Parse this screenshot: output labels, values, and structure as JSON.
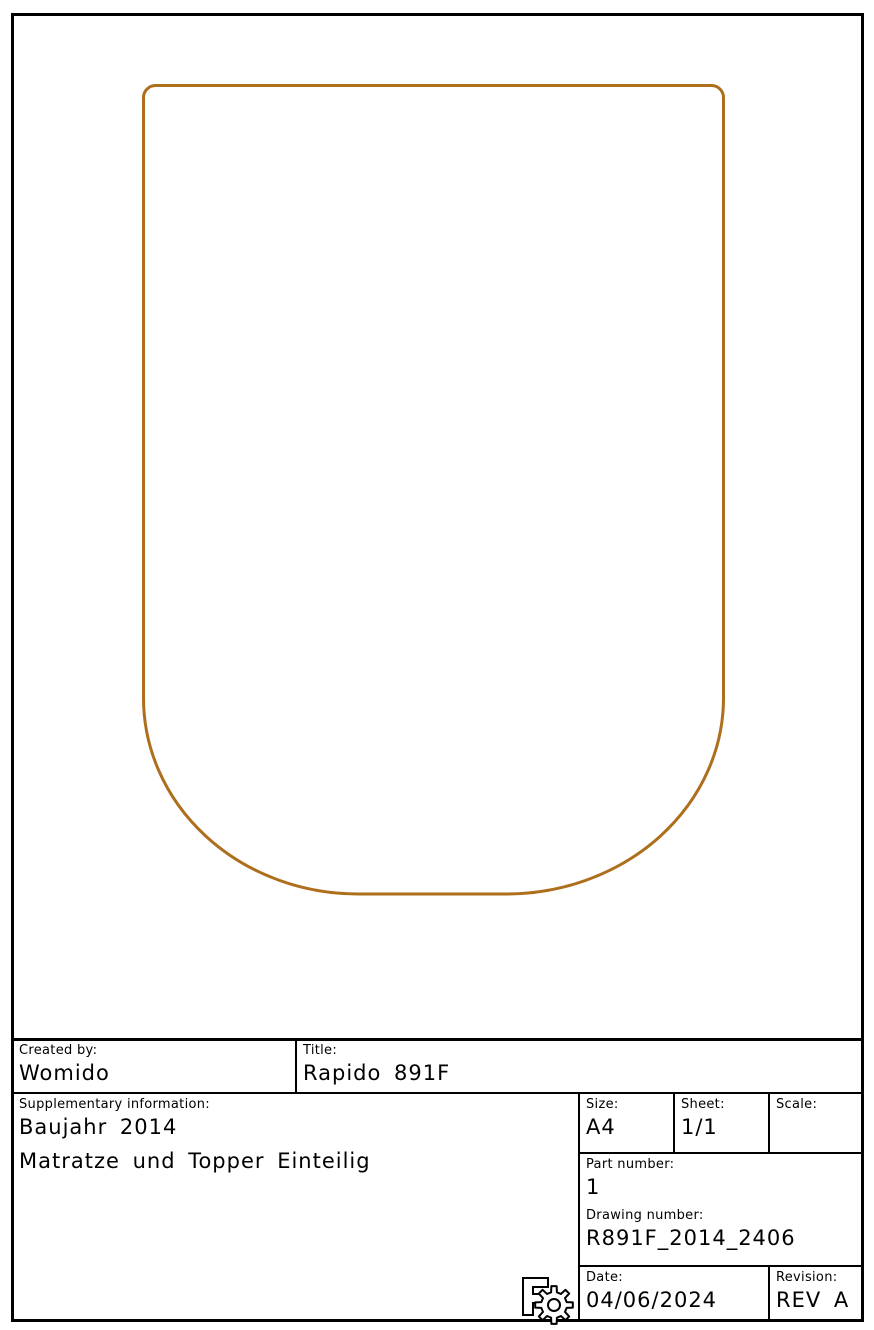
{
  "page": {
    "background": "#ffffff",
    "frame_color": "#000000"
  },
  "drawing": {
    "name": "mattress-outline",
    "outline_color": "#AE6F1D"
  },
  "title_block": {
    "created_by_label": "Created by:",
    "created_by_value": "Womido",
    "title_label": "Title:",
    "title_value": "Rapido 891F",
    "supplementary_label": "Supplementary information:",
    "supplementary_line1": "Baujahr 2014",
    "supplementary_line2": "Matratze und Topper Einteilig",
    "size_label": "Size:",
    "size_value": "A4",
    "sheet_label": "Sheet:",
    "sheet_value": "1/1",
    "scale_label": "Scale:",
    "scale_value": "",
    "part_number_label": "Part number:",
    "part_number_value": "1",
    "drawing_number_label": "Drawing number:",
    "drawing_number_value": "R891F_2014_2406",
    "date_label": "Date:",
    "date_value": "04/06/2024",
    "revision_label": "Revision:",
    "revision_value": "REV A"
  },
  "logo": {
    "name": "F gear logo"
  }
}
